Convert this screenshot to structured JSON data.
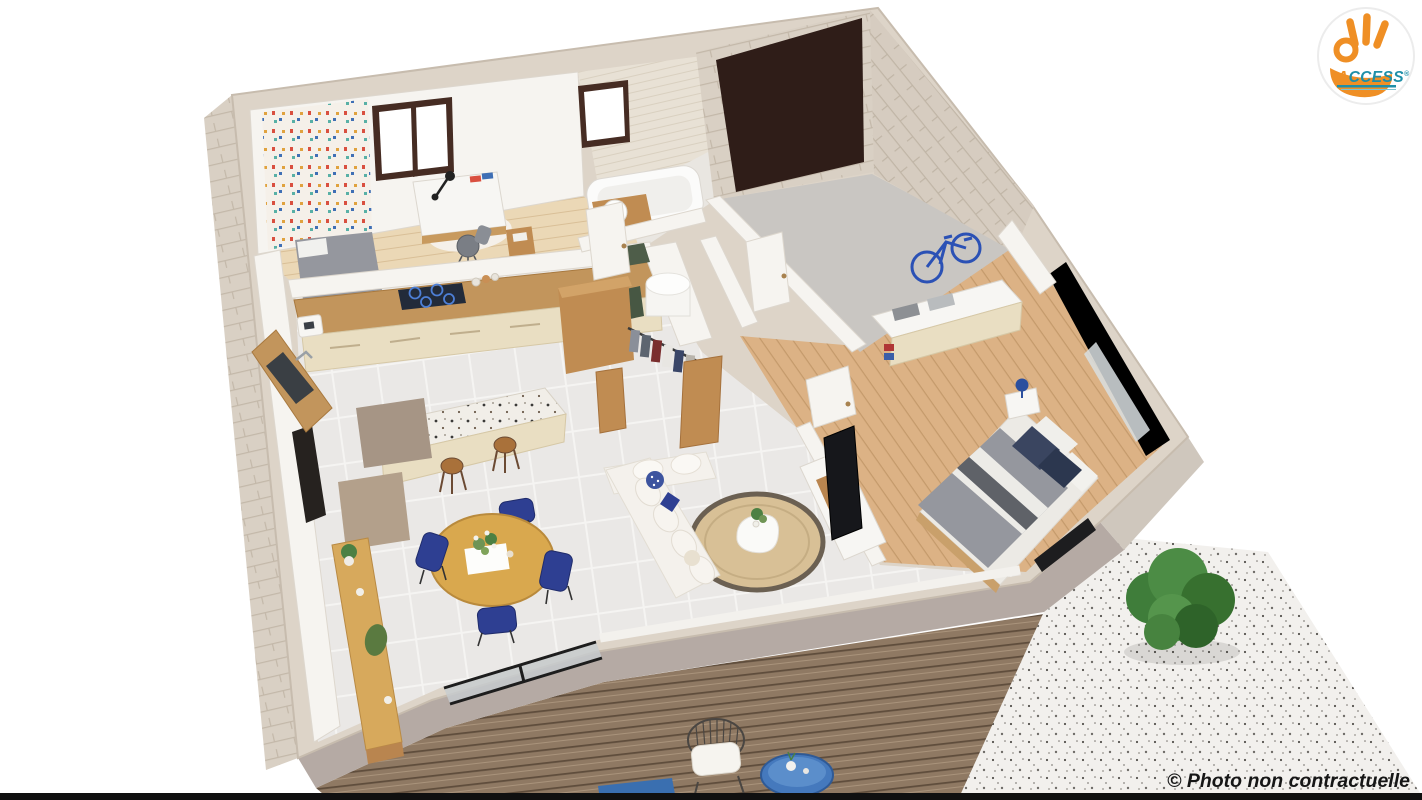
{
  "page": {
    "background": "#ffffff",
    "kind": "3d-floorplan-render"
  },
  "scene": {
    "description": "Isometric 3D cutaway render of a furnished single-storey house with wooden terrace deck and gravel patio",
    "rooms": [
      "bedroom-office",
      "kitchen",
      "dining-area",
      "living-room",
      "bathroom",
      "dressing-storage",
      "hallway",
      "garage",
      "master-bedroom",
      "terrace"
    ]
  },
  "branding": {
    "logo_text_accent": "A",
    "logo_text_rest": "CCESS",
    "logo_registered": "®",
    "badge_shape": "ok-hand gesture in orange inside white circular badge"
  },
  "watermark": {
    "text": "© Photo non contractuelle"
  },
  "palette": {
    "bg": "#ffffff",
    "wallTop": "#ddd4c8",
    "wallStroke": "#c7bcae",
    "frontFace": "#b5aaa4",
    "sideFace": "#cfc7bd",
    "interiorWall": "#f6f4f0",
    "tileFloor": "#eae8e6",
    "woodLightFloor": "#ebd8b6",
    "oakFloor": "#dcb285",
    "garageFloor": "#c9c6c2",
    "deck": "#8f7963",
    "gravel": "#f2f0ed",
    "stone": "#d9d0c4",
    "terrazzo": "#f1eee8",
    "tileWall": "#e8e1d5",
    "woodMid": "#c08c52",
    "woodCounter": "#c2955c",
    "cream": "#e9dec2",
    "hob": "#222b3a",
    "hobRing": "#4d7fd6",
    "navy": "#2e3f92",
    "duvet": "#95979e",
    "duvetDark": "#5f6268",
    "sofa": "#f4f1ec",
    "rug": "#d8c096",
    "rugRing": "#6b6052",
    "plant": "#4c8043",
    "garageDoor": "#2f1d18",
    "windowFrame": "#462c23",
    "glass": "#ffffff",
    "doorBlack": "#26221f",
    "terraceTable": "#4579bd",
    "bike": "#2b51b5",
    "logoOrange": "#ef8f25",
    "logoTeal": "#1f8fa8",
    "ink": "#161616",
    "blackBar": "#101010"
  }
}
